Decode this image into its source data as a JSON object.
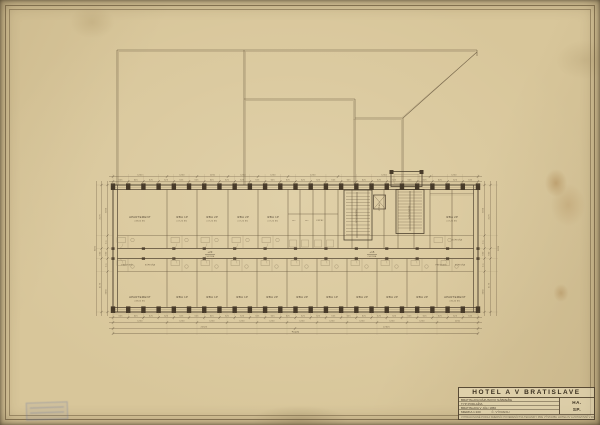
{
  "sheet": {
    "paper_color": "#d8c69a",
    "ink_dark": "#473a29",
    "ink_mid": "#62523a",
    "ink_light": "#8a795c",
    "stamp_color": "#7d8ab0"
  },
  "title_block": {
    "title": "HOTEL A V BRATISLAVE",
    "row1": "BRATISLAVA RÁZUSOVO NÁBREŽIE",
    "row2": "TYP PODLAŽIA",
    "row3": "BRATISLAVA V JÚLI 1950",
    "row4_label": "MIERKA 1:100",
    "row4_extra": "Č. VÝKRESU",
    "code_line1": "HA.",
    "code_line2": "SP.",
    "footer_note": "VYPRACOVANÉ PODĽA SMERNÍC POVERENÍCTVA TECHNIKY PRE VÝSTAVBU HOTELOV A ZOTAVOVNÍ V ROKU 1950"
  },
  "plan": {
    "rooms_top": [
      {
        "x": 140,
        "label": "APARTEMENT",
        "sub": "38,60 M²"
      },
      {
        "x": 182,
        "label": "IZBA 1P",
        "sub": "17,20 M²"
      },
      {
        "x": 212,
        "label": "IZBA 2P",
        "sub": "17,20 M²"
      },
      {
        "x": 243,
        "label": "IZBA 2P",
        "sub": "17,20 M²"
      },
      {
        "x": 273,
        "label": "IZBA 1P",
        "sub": "17,20 M²"
      },
      {
        "x": 452,
        "label": "IZBA 2P",
        "sub": "17,20 M²"
      }
    ],
    "rooms_bottom": [
      {
        "x": 140,
        "label": "APARTEMENT",
        "sub": "38,60 M²"
      },
      {
        "x": 182,
        "label": "IZBA 1P",
        "sub": ""
      },
      {
        "x": 212,
        "label": "IZBA 1P",
        "sub": ""
      },
      {
        "x": 242,
        "label": "IZBA 1P",
        "sub": ""
      },
      {
        "x": 272,
        "label": "IZBA 2P",
        "sub": ""
      },
      {
        "x": 302,
        "label": "IZBA 2P",
        "sub": ""
      },
      {
        "x": 332,
        "label": "IZBA 1P",
        "sub": ""
      },
      {
        "x": 362,
        "label": "IZBA 2P",
        "sub": ""
      },
      {
        "x": 392,
        "label": "IZBA 2P",
        "sub": ""
      },
      {
        "x": 422,
        "label": "IZBA 2P",
        "sub": ""
      },
      {
        "x": 455,
        "label": "APARTEMENT",
        "sub": "36,40 M²"
      }
    ],
    "band_labels": [
      {
        "x": 127,
        "y": 265.5,
        "label": "PREDSIEŇ"
      },
      {
        "x": 150,
        "y": 265.5,
        "label": "KÚPEĽŇA"
      },
      {
        "x": 441,
        "y": 265.5,
        "label": "PREDSIEŇ"
      },
      {
        "x": 460,
        "y": 265.5,
        "label": "KÚPEĽŇA"
      },
      {
        "x": 294,
        "y": 221,
        "label": "WC"
      },
      {
        "x": 307,
        "y": 221,
        "label": "WC"
      },
      {
        "x": 320,
        "y": 221,
        "label": "KÚPEĽ"
      },
      {
        "x": 457,
        "y": 240.5,
        "label": "KÚPEĽŇA"
      }
    ],
    "stair_labels": [
      {
        "x": 357,
        "y": 216,
        "label": "SCHODIŠTE",
        "rot": -90
      },
      {
        "x": 380,
        "y": 207,
        "label": "VÝŤAH",
        "rot": -90
      },
      {
        "x": 410,
        "y": 212,
        "label": "SCHODIŠTE",
        "rot": -90
      }
    ],
    "corridor_markers": [
      {
        "x": 210,
        "label": "+23",
        "sub": "CHODBA"
      },
      {
        "x": 372,
        "label": "+15",
        "sub": "CHODBA"
      }
    ]
  },
  "dims": {
    "bay": "625",
    "room": "1250",
    "bottom_segments": [
      "22625",
      "22625"
    ],
    "total": "45250",
    "side_small": [
      "3050",
      "850",
      "650",
      "850",
      "3050"
    ],
    "side_mid": [
      "4175",
      "650",
      "4175"
    ],
    "side_total": "9000"
  }
}
